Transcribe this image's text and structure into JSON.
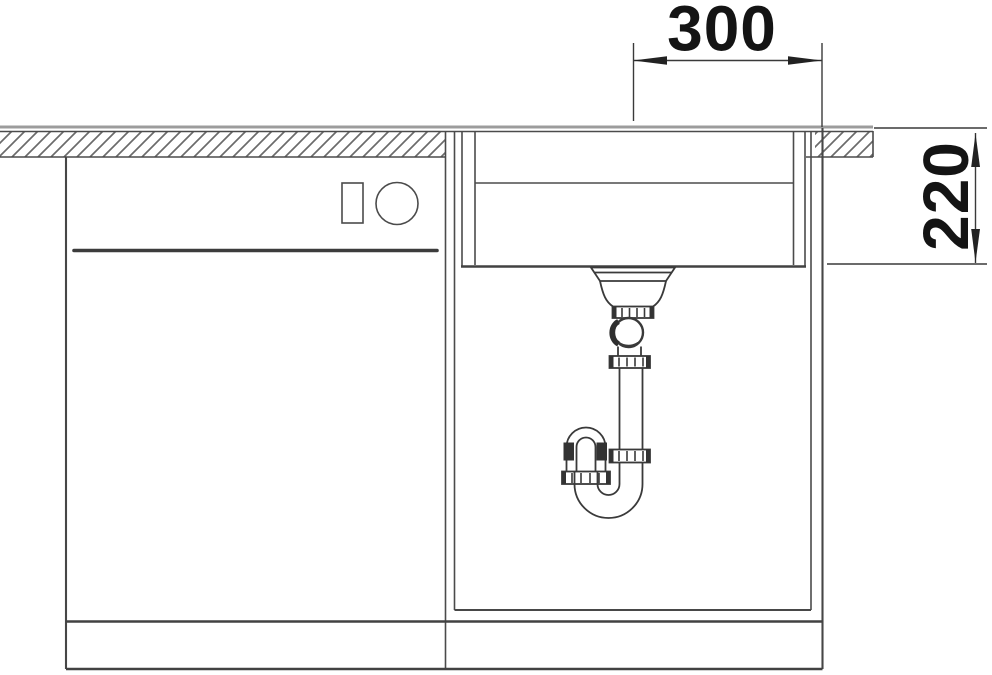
{
  "dimensions": {
    "horizontal": {
      "label": "300"
    },
    "vertical": {
      "label": "220"
    }
  },
  "colors": {
    "background": "#ffffff",
    "line": "#4b4b4b",
    "countertop_surface_line": "#9c9c9c",
    "hatch": "#6b6b6b",
    "dimension_text": "#141414"
  },
  "symbols": {
    "dimension_arrowheads": "filled-triangle-arrow",
    "countertop_fill": "diagonal-hatch",
    "appliance_symbols": [
      "small-rectangle",
      "circle"
    ]
  }
}
